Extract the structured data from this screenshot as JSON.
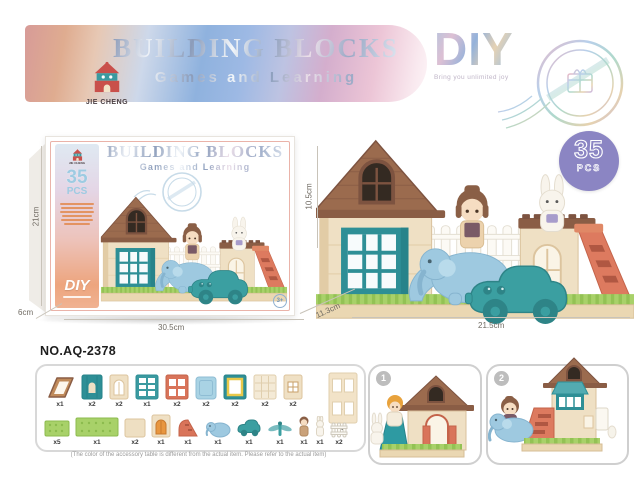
{
  "header": {
    "brand": "JIE CHENG",
    "title": "BUILDING BLOCKS",
    "subtitle": "Games and Learning",
    "diy_title": "DIY",
    "diy_tagline": "Bring you unlimited joy"
  },
  "box": {
    "title": "BUILDING BLOCKS",
    "subtitle": "Games and Learning",
    "pcs_number": "35",
    "pcs_label": "PCS",
    "diy_label": "DIY",
    "age_badge": "3+",
    "dim_height": "21cm",
    "dim_depth": "6cm",
    "dim_width": "30.5cm"
  },
  "photo": {
    "badge_number": "35",
    "badge_label": "PCS",
    "dim_height": "10.5cm",
    "dim_depth": "11.3cm",
    "dim_width": "21.5cm"
  },
  "model_no": "NO.AQ-2378",
  "parts": {
    "note": "(The color of the accessory table is different from the actual item. Please refer to the actual item)",
    "row1": [
      {
        "name": "roof-panel",
        "qty": "x1"
      },
      {
        "name": "teal-door-panel",
        "qty": "x2"
      },
      {
        "name": "arch-window-panel",
        "qty": "x2"
      },
      {
        "name": "teal-grid-window-panel",
        "qty": "x1"
      },
      {
        "name": "red-window-panel",
        "qty": "x2"
      },
      {
        "name": "blue-square-panel",
        "qty": "x2"
      },
      {
        "name": "yellow-frame-panel",
        "qty": "x2"
      },
      {
        "name": "lattice-panel",
        "qty": "x2"
      },
      {
        "name": "small-window-panel",
        "qty": "x2"
      }
    ],
    "big_panel": {
      "name": "four-hole-wall-panel",
      "qty": "x2"
    },
    "row2": [
      {
        "name": "small-baseplate",
        "qty": "x5"
      },
      {
        "name": "large-baseplate",
        "qty": "x1"
      },
      {
        "name": "plain-panel",
        "qty": "x2"
      },
      {
        "name": "door-panel",
        "qty": "x1"
      },
      {
        "name": "slide",
        "qty": "x1"
      },
      {
        "name": "elephant-slide",
        "qty": "x1"
      },
      {
        "name": "car",
        "qty": "x1"
      },
      {
        "name": "dragonfly",
        "qty": "x1"
      },
      {
        "name": "girl-figure",
        "qty": "x1"
      },
      {
        "name": "rabbit-figure",
        "qty": "x1"
      },
      {
        "name": "fence",
        "qty": "x2"
      }
    ]
  },
  "assembly": {
    "step1": "1",
    "step2": "2"
  },
  "icons": {
    "logo": "castle-house-icon",
    "stamp": "postmark-gift-stamp-icon"
  },
  "colors": {
    "accent_purple": "#8b85c3",
    "teal": "#2e8f96",
    "coral": "#dd7a5f",
    "cream": "#efe0c4",
    "green": "#a8d169",
    "roof_brown": "#9b6b4e"
  }
}
